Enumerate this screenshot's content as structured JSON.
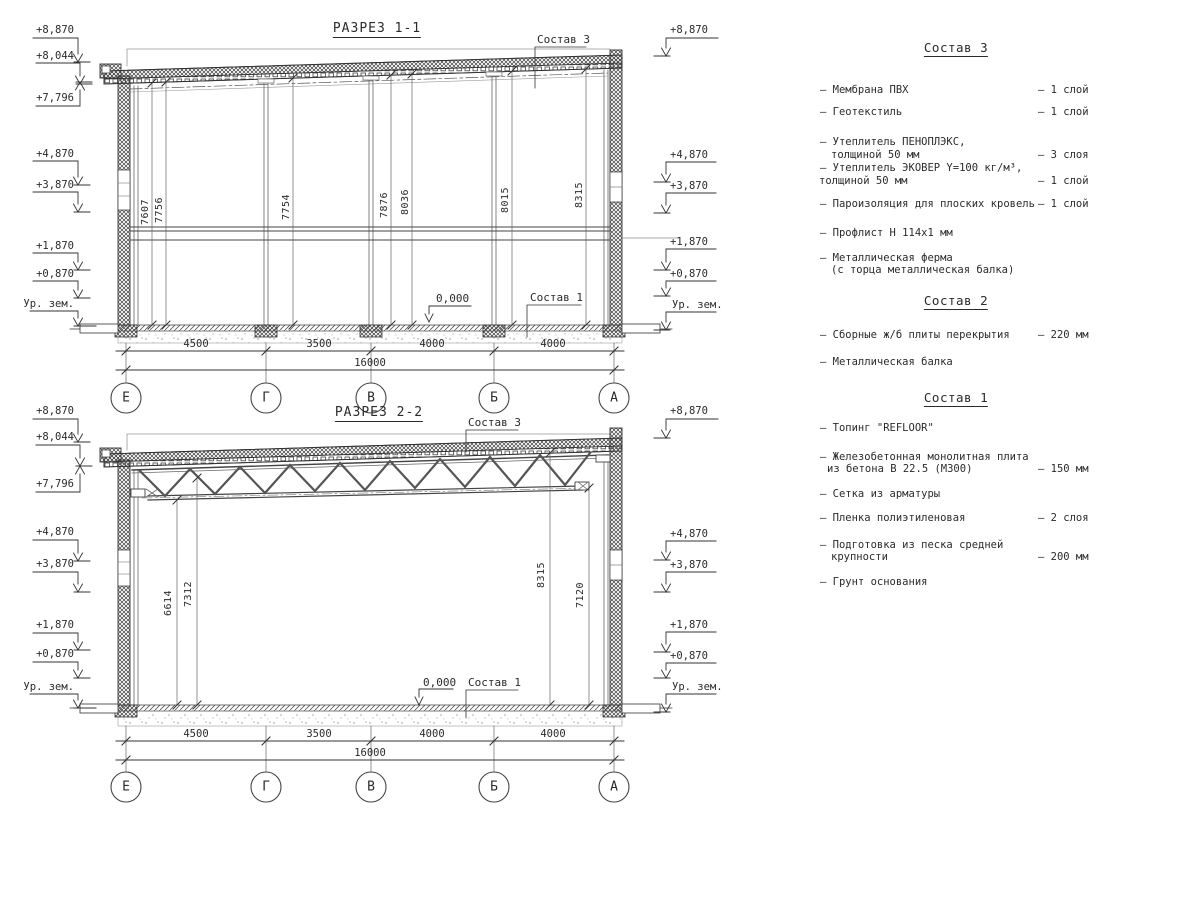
{
  "sections": [
    {
      "title": "РАЗРЕЗ 1-1",
      "elev_left": [
        "+8,870",
        "+8,044",
        "+7,796",
        "+4,870",
        "+3,870",
        "+1,870",
        "+0,870",
        "Ур. зем."
      ],
      "elev_right": [
        "+8,870",
        "+4,870",
        "+3,870",
        "+1,870",
        "+0,870",
        "Ур. зем."
      ],
      "vdims": [
        "7607",
        "7756",
        "7754",
        "7876",
        "8036",
        "8015",
        "8315"
      ],
      "hdims": [
        "4500",
        "3500",
        "4000",
        "4000"
      ],
      "total": "16000",
      "axes": [
        "Е",
        "Г",
        "В",
        "Б",
        "А"
      ],
      "callouts": {
        "roof": "Состав 3",
        "floor": "Состав 1",
        "zero": "0,000"
      }
    },
    {
      "title": "РАЗРЕЗ 2-2",
      "elev_left": [
        "+8,870",
        "+8,044",
        "+7,796",
        "+4,870",
        "+3,870",
        "+1,870",
        "+0,870",
        "Ур. зем."
      ],
      "elev_right": [
        "+8,870",
        "+4,870",
        "+3,870",
        "+1,870",
        "+0,870",
        "Ур. зем."
      ],
      "vdims": [
        "6614",
        "7312",
        "8315",
        "7120"
      ],
      "hdims": [
        "4500",
        "3500",
        "4000",
        "4000"
      ],
      "total": "16000",
      "axes": [
        "Е",
        "Г",
        "В",
        "Б",
        "А"
      ],
      "callouts": {
        "roof": "Состав 3",
        "floor": "Состав 1",
        "zero": "0,000"
      }
    }
  ],
  "legend": {
    "blocks": [
      {
        "title": "Состав 3",
        "rows": [
          {
            "t": "– Мембрана ПВХ",
            "v": "– 1 слой"
          },
          {
            "t": "– Геотекстиль",
            "v": "– 1 слой"
          },
          {
            "t": "– Утеплитель ПЕНОПЛЭКС,",
            "v": ""
          },
          {
            "t": "толщиной 50 мм",
            "v": "– 3 слоя"
          },
          {
            "t": "– Утеплитель ЭКОВЕР Y=100 кг/м³,",
            "v": ""
          },
          {
            "t": "толщиной 50 мм",
            "v": "– 1 слой"
          },
          {
            "t": "– Пароизоляция для плоских кровель",
            "v": "– 1 слой"
          },
          {
            "t": "– Профлист Н 114х1 мм",
            "v": ""
          },
          {
            "t": "– Металлическая ферма",
            "v": ""
          },
          {
            "t": "(с торца металлическая балка)",
            "v": ""
          }
        ]
      },
      {
        "title": "Состав 2",
        "rows": [
          {
            "t": "– Сборные ж/б плиты перекрытия",
            "v": "– 220 мм"
          },
          {
            "t": "– Металлическая балка",
            "v": ""
          }
        ]
      },
      {
        "title": "Состав 1",
        "rows": [
          {
            "t": "– Топинг \"REFLOOR\"",
            "v": ""
          },
          {
            "t": "– Железобетонная  монолитная плита",
            "v": ""
          },
          {
            "t": "из бетона В 22.5 (М300)",
            "v": "– 150 мм"
          },
          {
            "t": "– Сетка из арматуры",
            "v": ""
          },
          {
            "t": "– Пленка полиэтиленовая",
            "v": "–  2 слоя"
          },
          {
            "t": "– Подготовка из песка средней",
            "v": ""
          },
          {
            "t": "крупности",
            "v": "– 200 мм"
          },
          {
            "t": "– Грунт основания",
            "v": ""
          }
        ]
      }
    ]
  }
}
